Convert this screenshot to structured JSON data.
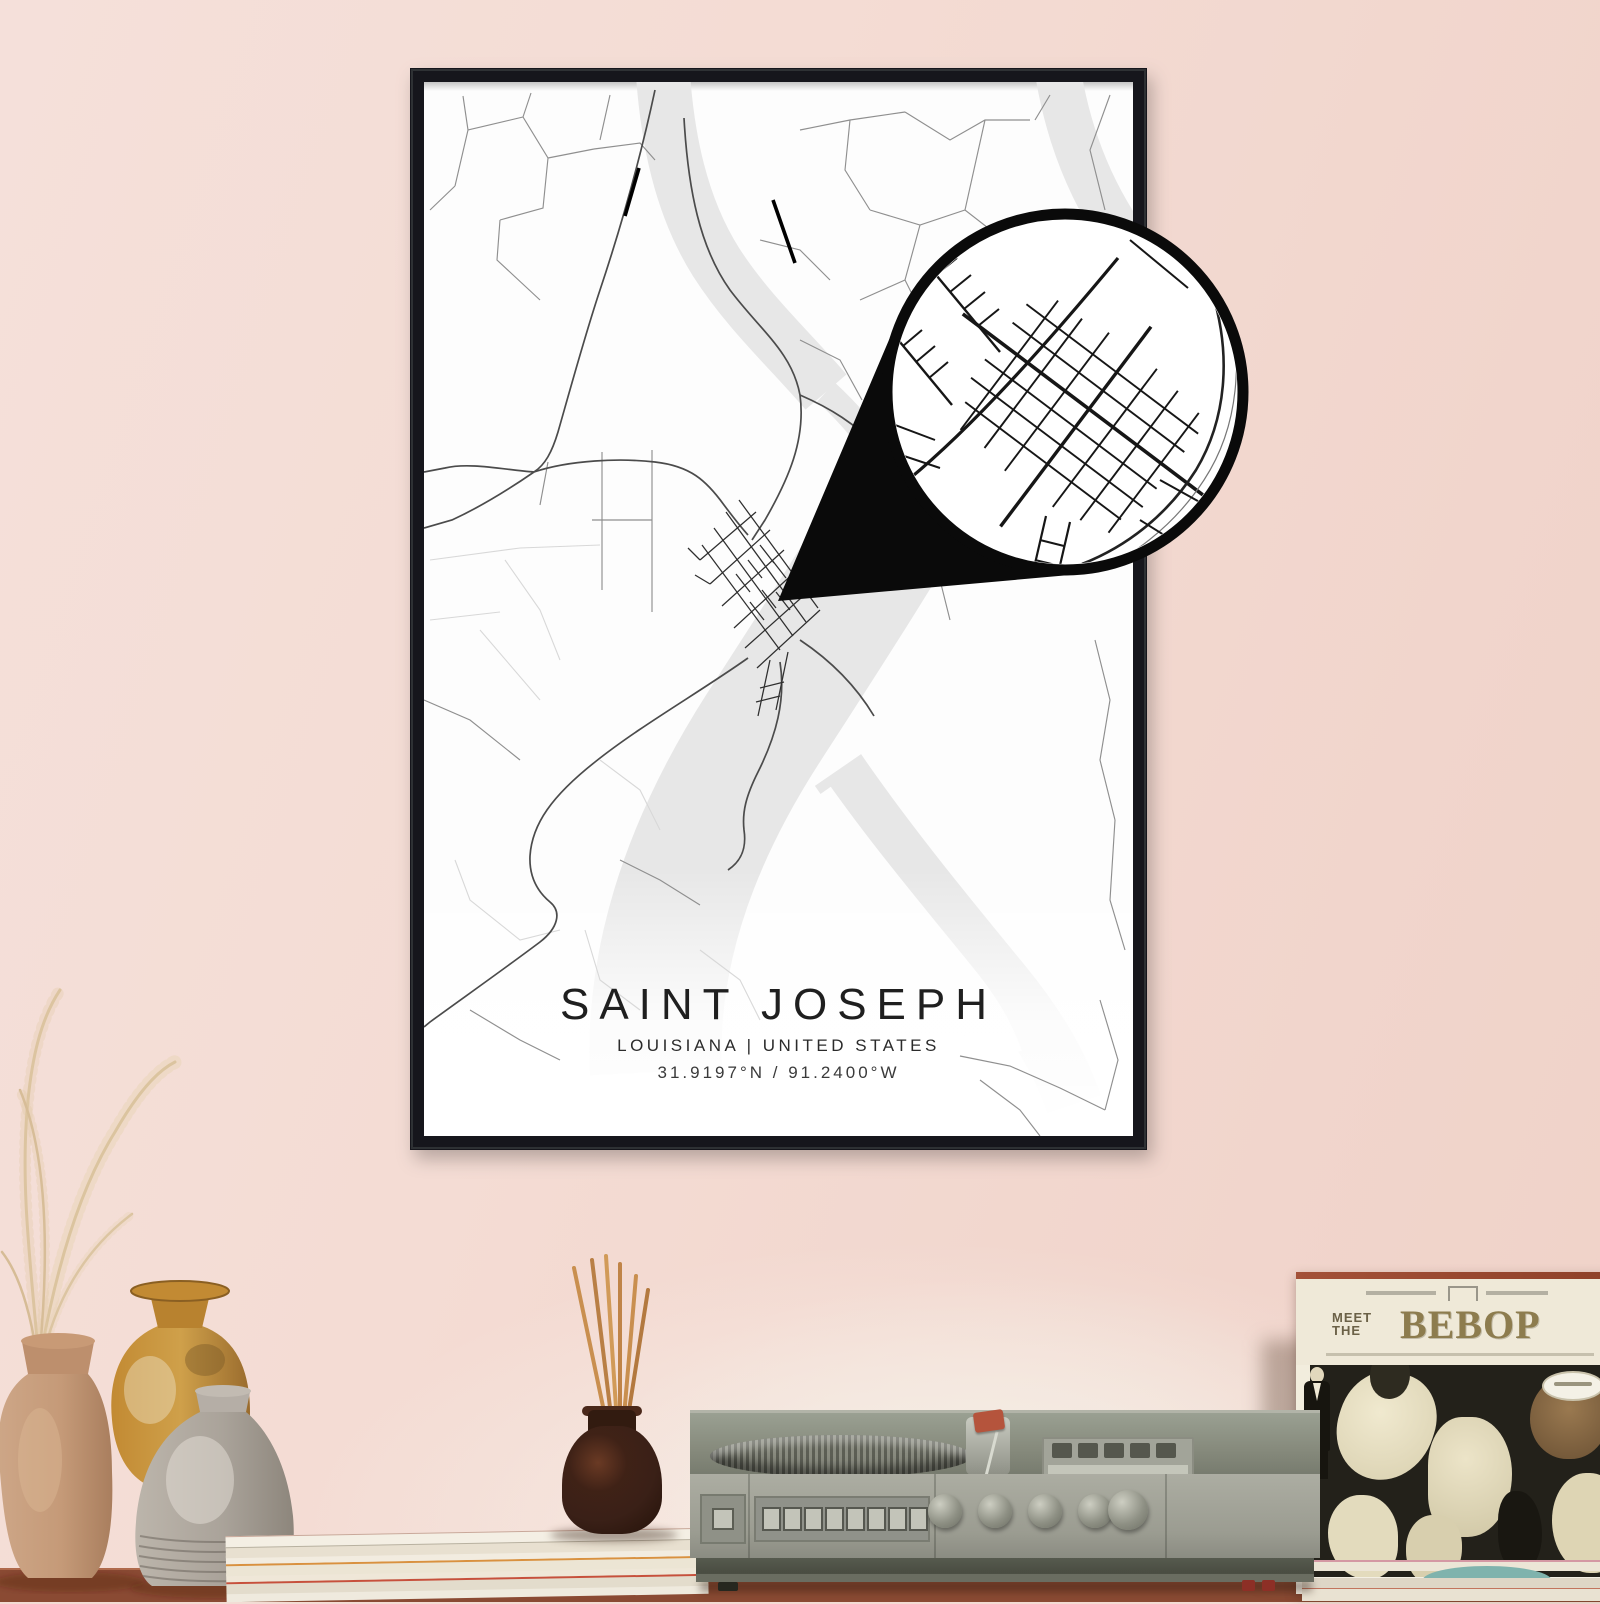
{
  "poster": {
    "title": "SAINT JOSEPH",
    "subtitle": "LOUISIANA | UNITED STATES",
    "coordinates": "31.9197°N / 91.2400°W",
    "frame_color": "#17191b",
    "paper_color": "#fdfdfd",
    "water_color": "#e7e7e7",
    "road_color": "#8f8f8f",
    "main_road_color": "#4b4b4b",
    "detail_road_color": "#141414"
  },
  "magnifier": {
    "border_color": "#0a0a0a",
    "fill_color": "#ffffff",
    "pointer_color": "#0a0a0a"
  },
  "record_sleeve": {
    "pretitle_top": "MEET",
    "pretitle_bottom": "THE",
    "title": "BEBOP",
    "title_color": "#8d7c4e",
    "cover_background": "#efe9d8",
    "artwork_background": "#23211a"
  },
  "scene": {
    "wall_color_top": "#f1d5cc",
    "wall_color_bottom": "#f7e9e4",
    "shelf_wood_color": "#8a4a33",
    "vase_colors": [
      "#c59a78",
      "#c28a33",
      "#aaa39a"
    ],
    "diffuser_bottle_color": "#3a2017",
    "player_body_color": "#9a9c91"
  }
}
